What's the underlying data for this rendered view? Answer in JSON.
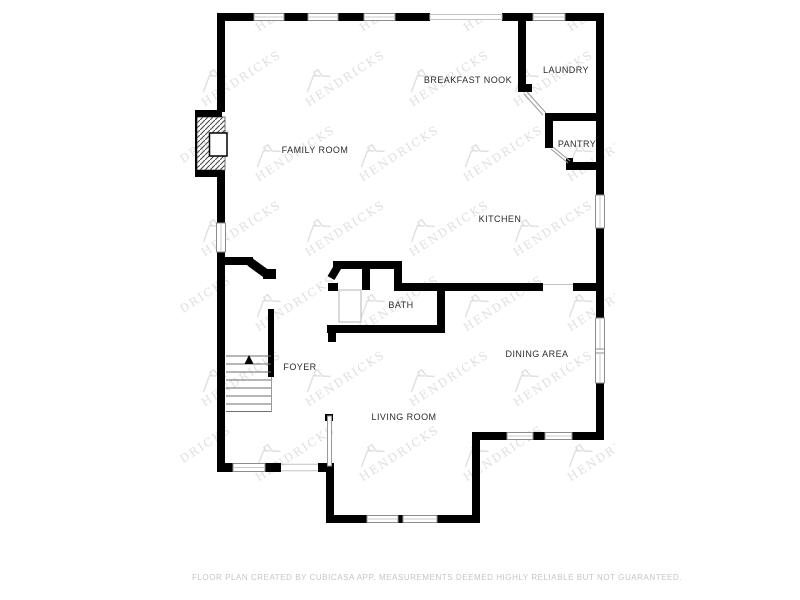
{
  "rooms": [
    {
      "id": "family-room",
      "name": "FAMILY ROOM"
    },
    {
      "id": "breakfast-nook",
      "name": "BREAKFAST NOOK"
    },
    {
      "id": "laundry",
      "name": "LAUNDRY"
    },
    {
      "id": "pantry",
      "name": "PANTRY"
    },
    {
      "id": "kitchen",
      "name": "KITCHEN"
    },
    {
      "id": "bath",
      "name": "BATH"
    },
    {
      "id": "dining-area",
      "name": "DINING AREA"
    },
    {
      "id": "foyer",
      "name": "FOYER"
    },
    {
      "id": "living-room",
      "name": "LIVING ROOM"
    }
  ],
  "features": {
    "stairs_direction": "up",
    "fireplace": "family-room exterior wall",
    "doors": [
      "laundry swing door",
      "pantry swing door"
    ],
    "openings": [
      "breakfast nook rear opening",
      "front entry opening",
      "kitchen-dining cased opening"
    ]
  },
  "watermark": {
    "text": "HENDRICKS"
  },
  "footer": {
    "disclaimer": "FLOOR PLAN CREATED BY CUBICASA APP. MEASUREMENTS DEEMED HIGHLY RELIABLE BUT NOT GUARANTEED."
  },
  "colors": {
    "background": "#ffffff",
    "wall": "#000000",
    "window_frame": "#8c8c8c",
    "thin_line": "#b5b5b5",
    "label": "#2b2b2b",
    "watermark": "#dcdcdc",
    "footer": "#c5c5c5"
  }
}
